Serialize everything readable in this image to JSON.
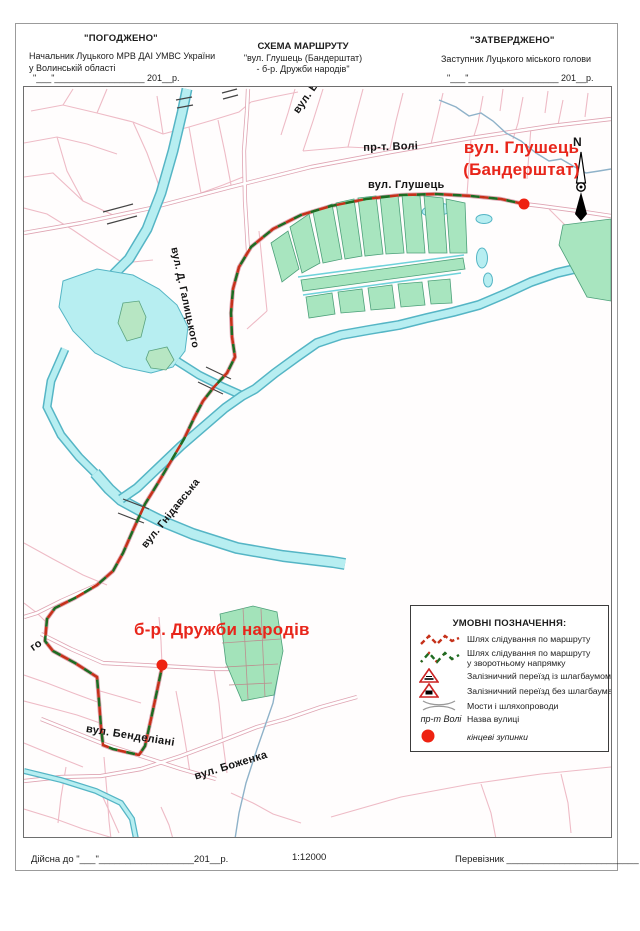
{
  "header": {
    "left": {
      "stamp": "\"ПОГОДЖЕНО\"",
      "line1": "Начальник Луцького МРВ ДАІ УМВС України",
      "line2": "у Волинській області",
      "date": "\"___\"__________________ 201__р."
    },
    "center": {
      "line1": "СХЕМА МАРШРУТУ",
      "line2": "\"вул. Глушець (Бандерштат)",
      "line3": "- б-р. Дружби народів\""
    },
    "right": {
      "stamp": "\"ЗАТВЕРДЖЕНО\"",
      "line1": "Заступник Луцького міського голови",
      "date": "\"___\"__________________ 201__р."
    }
  },
  "map": {
    "north_label": "N",
    "terminus_labels": {
      "glushets_line1": "вул. Глушець",
      "glushets_line2": "(Бандерштат)",
      "druzhby": "б-р. Дружби народів"
    },
    "streets": {
      "prospekt_voli": "пр-т. Волі",
      "hlushets": "вул. Глушець",
      "halytskoho": "вул. Д. Галицького",
      "hnidavska": "вул. Гнідавська",
      "bendeliani": "вул. Бенделіані",
      "bozhenka": "вул. Боженка",
      "partial_top": "вул. В",
      "partial_left": "го"
    }
  },
  "legend": {
    "title": "УМОВНІ ПОЗНАЧЕННЯ:",
    "items": [
      {
        "label": "Шлях слідування по маршруту"
      },
      {
        "label": "Шлях слідування по маршруту",
        "label2": "у зворотньому напрямку"
      },
      {
        "label": "Залізничний переїзд із шлагбаумом"
      },
      {
        "label": "Залізничний переїзд без шлагбаума"
      },
      {
        "label": "Мости і шляхопроводи"
      },
      {
        "example": "пр-т Волі",
        "label": "Назва вулиці"
      },
      {
        "label": "кінцеві зупинки"
      }
    ]
  },
  "footer": {
    "valid": "Дійсна до \"___\"__________________201__р.",
    "scale": "1:12000",
    "carrier": "Перевізник _________________________"
  },
  "colors": {
    "route_forward": "#c5311a",
    "route_reverse": "#1e6b21",
    "terminus_dot": "#ee2211",
    "water": "#b7eef1",
    "green_area": "#a8e5bf",
    "road": "#eebbc6"
  }
}
